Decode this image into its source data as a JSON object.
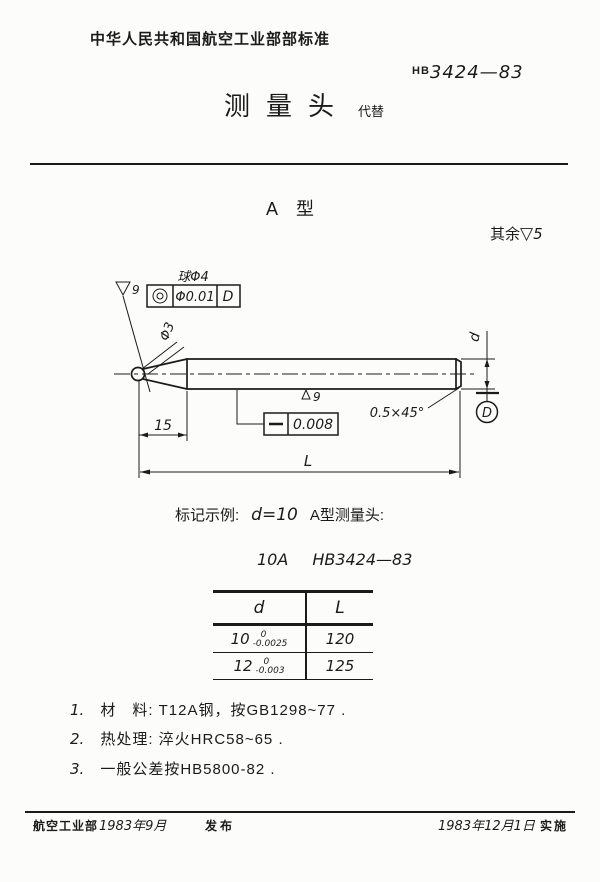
{
  "header": {
    "ministry_title": "中华人民共和国航空工业部部标准",
    "standard_prefix": "HB",
    "standard_number": "3424—83",
    "doc_title": "测量头",
    "replaces_label": "代替"
  },
  "type_heading": "A 型",
  "surface_note": {
    "prefix": "其余",
    "symbol": "▽",
    "grade": "5"
  },
  "drawing": {
    "ball_dia_label": "球Φ4",
    "concentricity": {
      "symbol": "◎",
      "tolerance": "Φ0.01",
      "datum": "D"
    },
    "ball_roughness": "9",
    "stem_dia_label": "Φ3",
    "body_roughness": "9",
    "straightness": {
      "symbol": "—",
      "tolerance": "0.008"
    },
    "chamfer_label": "0.5×45°",
    "tip_length": "15",
    "length_label": "L",
    "dia_label": "d",
    "datum_label": "D"
  },
  "marking": {
    "example_prefix": "标记示例:",
    "example_formula": "d=10",
    "example_suffix": "A型测量头:",
    "designation_code": "10A",
    "designation_standard": "HB3424—83"
  },
  "table": {
    "col_d": "d",
    "col_L": "L",
    "rows": [
      {
        "nominal": "10",
        "upper": "0",
        "lower": "-0.0025",
        "length": "120"
      },
      {
        "nominal": "12",
        "upper": "0",
        "lower": "-0.003",
        "length": "125"
      }
    ]
  },
  "notes": [
    {
      "num": "1.",
      "text": "材　料: T12A钢，按GB1298~77 ."
    },
    {
      "num": "2.",
      "text": "热处理: 淬火HRC58~65 ."
    },
    {
      "num": "3.",
      "text": "一般公差按HB5800-82 ."
    }
  ],
  "footer": {
    "org": "航空工业部",
    "issue_date": "1983年9月",
    "issue_label": "发布",
    "impl_date": "1983年12月1日",
    "impl_label": "实施"
  }
}
